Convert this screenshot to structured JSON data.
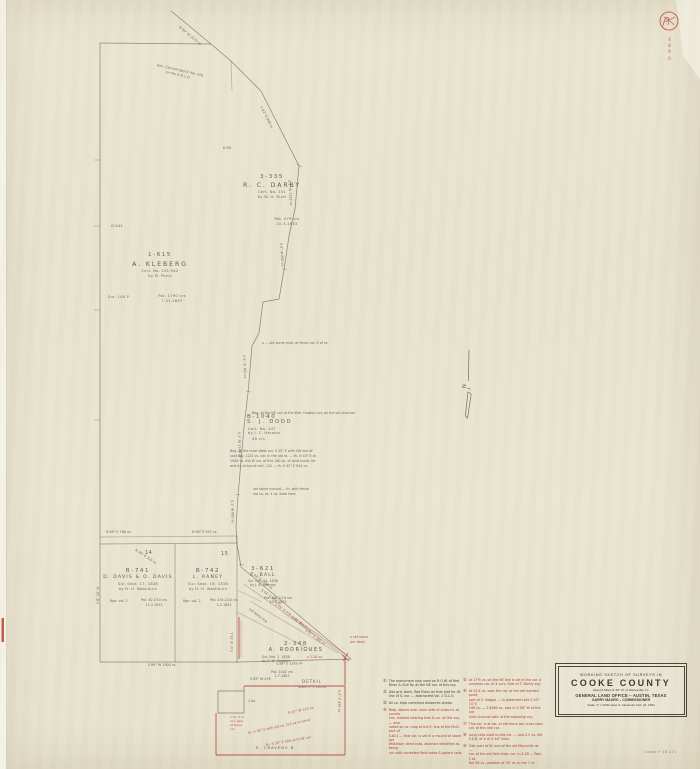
{
  "stamp": {
    "digits": [
      "4",
      "8",
      "9",
      "0"
    ]
  },
  "footer_ref": "Cooke  P 48  271",
  "north": {
    "label": "N"
  },
  "title_block": {
    "line1": "WORKING SKETCH OF SURVEYS IN",
    "county": "COOKE COUNTY",
    "subtitle": "About 8 Miles N. 60° W. of Gainesville, Tx.",
    "office": "GENERAL LAND OFFICE – AUSTIN, TEXAS",
    "commissioner": "GARRY MAURO – COMMISSIONER",
    "scale_line": "Scale: 1\" = 2000 varas      S. Alexander   Feb. 24, 1984"
  },
  "surveys": {
    "darby": {
      "id": "3-335",
      "name": "R. C. DARBY",
      "l1": "Cert. No. 141",
      "l2": "by W. H. Hunt",
      "p1": "Pat. 479 vrs",
      "p2": "10-3-1853"
    },
    "kleberg": {
      "id": "1-615",
      "name": "A. KLEBERG",
      "l1": "Cert. No. 241/342",
      "l2": "by M. Perry",
      "p1": "Pat. 1790 vrs",
      "p2": "7-31-1857",
      "extra": "Sur. 146  P"
    },
    "dodd": {
      "id": "B-1040",
      "name": "S. J. DODD",
      "l1": "Cert. No. 147",
      "l2": "by J. C. Harmon",
      "l3": "48 vrs"
    },
    "davis": {
      "id": "B-741",
      "name": "D. DAVIS & O. DAVIS",
      "l1": "Sur. Sept. 17, 1838",
      "l2": "by H. H. Washburn",
      "r": "Rge. vol. 2",
      "p1": "Pat. 40 2/10 vrs",
      "p2": "11-2-1853"
    },
    "raney": {
      "id": "B-742",
      "name": "L. RANEY",
      "l1": "Sur. Sept. 16, 1838",
      "l2": "by H. H. Washburn",
      "r": "Rge. vol. 2",
      "p1": "Pat. 476 2/10 vrs",
      "p2": "2-2-1853"
    },
    "ball": {
      "id": "3-621",
      "name": "E. BALL",
      "l1": "Sur. Oct. 15, 1838",
      "l2": "by J. B. Harmon",
      "p1": "Pat. 448 2/10 vrs",
      "p2": "10-3-1853"
    },
    "rodrigues": {
      "id": "2-348",
      "name": "A. RODRIGUES",
      "l1": "Sur. Feb. 2, 1838",
      "l2": "by G. W. Rodgers",
      "p1": "Pat. 2402 vrs",
      "p2": "1-7-1853"
    }
  },
  "blocks": {
    "b14": "14",
    "b15": "15"
  },
  "misc": {
    "k95": "K-95",
    "g441": "G-441",
    "cravens": "E. CRAVENS   B",
    "detail": "DETAIL",
    "detail_scale": "Scale: 1\" = 200 vs",
    "one_acre": "1 Ac.",
    "above_parcel": "S 89° W 476",
    "rod_red": "x 2.20 vs"
  },
  "bearings": {
    "top_diag": "N 45° W 2170 vs",
    "cantrell1": "Geo. Cantrell Sketch No. 429",
    "cantrell2": "on file in G.L.O.",
    "e1": "S 62° E 940 vs",
    "e2": "S 5° W 1122 vs",
    "e3": "S 6° W 890 vs",
    "e4": "S 4° W 760 vs",
    "e5": "S 2° W 1148 vs",
    "e6": "S 1° W 985 vs",
    "f1": "S 44° E 1090 vs",
    "f2": "S 44° E 952 vs",
    "f3": "S 45° E 476 vs to rd.",
    "f4": "S 44° E 620 vs",
    "f5": "S 45° E 380 vs",
    "f6": "old fence line",
    "bottom1": "S 89° W 1900 vs",
    "bottom2": "S 89° E 1192 vs",
    "p1": "N 89° E 766 vs",
    "p2": "N 45° E 320 vs",
    "p3": "N 89° E 952 vs",
    "left1": "S 0° 20' W",
    "red29": "S 0° W 29.1",
    "rd1": "S 0° E 476 vs"
  },
  "annotations": {
    "a1": "x — old stone mnd. at fence cor. E of rd.",
    "a2": "Beg. at the NE cor. of the Wm. Hudson svy. on the old channel",
    "a3": [
      "Beg. at the most West cor. S 45° E with SW line of",
      "said svy. 1122 vs. cor. in the old rd. — th. N 45° E at",
      "1900 vs. the W cor. of this 160 ac. of land survd. for",
      "and by virtue of cert. 142 — th. S 45° E 944 vs."
    ],
    "a4": [
      "set stone mound — th. with fence",
      "old co. rd. 4 vs. wide here"
    ],
    "r1": [
      "x set stone",
      "per deed"
    ],
    "rp1": "th. S 48° E with old rd. 214 vs to bend",
    "rp2": "th. S 52° E 186 vs to SE cor.",
    "rp3": [
      "x fd. ½ in.",
      "iron pipe",
      "at fence",
      "cor."
    ],
    "rp4": "N 47° W 310 vs"
  },
  "notes": {
    "left": [
      {
        "num": "①",
        "lines": [
          "The monument now used on R.O.W. of Red",
          "River & Gulf Ry. at the NE cor. of this svy."
        ]
      },
      {
        "num": "②",
        "lines": [
          "Alta grd. bank, Red River on that plat for W.",
          "line of S. cor. — abstracted Vol. 2  G.L.O."
        ]
      },
      {
        "num": "③",
        "lines": [
          "All co. map corrected distances shown."
        ]
      },
      {
        "num": "④",
        "lines": [
          "Bldg. stones mon. each side of cross rd. at county",
          "line, marked bearing tree & cor. of this svy. — also",
          "noted on co. map at the E. line of the McD. part of",
          "S-621 — that cor. is set in a mound of stone  per",
          "Wilkinson deed calls, abstract identified as being",
          "run with corrected field notes & patent calls."
        ]
      }
    ],
    "right": [
      {
        "num": "⑤",
        "lines": [
          "At 17½ vs. on the NE line is set in the cor. a",
          "common cor. of 4 surs. East of T. Darby svy."
        ]
      },
      {
        "num": "⑥",
        "lines": [
          "At 23.4 vs. over the cor. of the old marked point,",
          "part of S. league — to patented calls S 43° 10' E",
          "548 vs. — 2.8480 ac. also in S 58° W of the old",
          "river channel calls of the adjoining svy."
        ]
      },
      {
        "num": "⑦",
        "lines": [
          "This cor. is at cor. of old fence per cross road",
          "cor. of this line cor."
        ]
      },
      {
        "num": "⑧",
        "lines": [
          "Long calls used to site cor. — and 2.5 vs. left",
          "S.E.B. of it at S 46° links."
        ]
      },
      {
        "num": "⑨",
        "lines": [
          "Site: part of W. end of the old Maysville rd. —",
          "cor. of the old field lines, cor. in S-28 — Red. S at",
          "the 58 vs., position of 20' rd. in the 7 vr."
        ]
      }
    ]
  }
}
